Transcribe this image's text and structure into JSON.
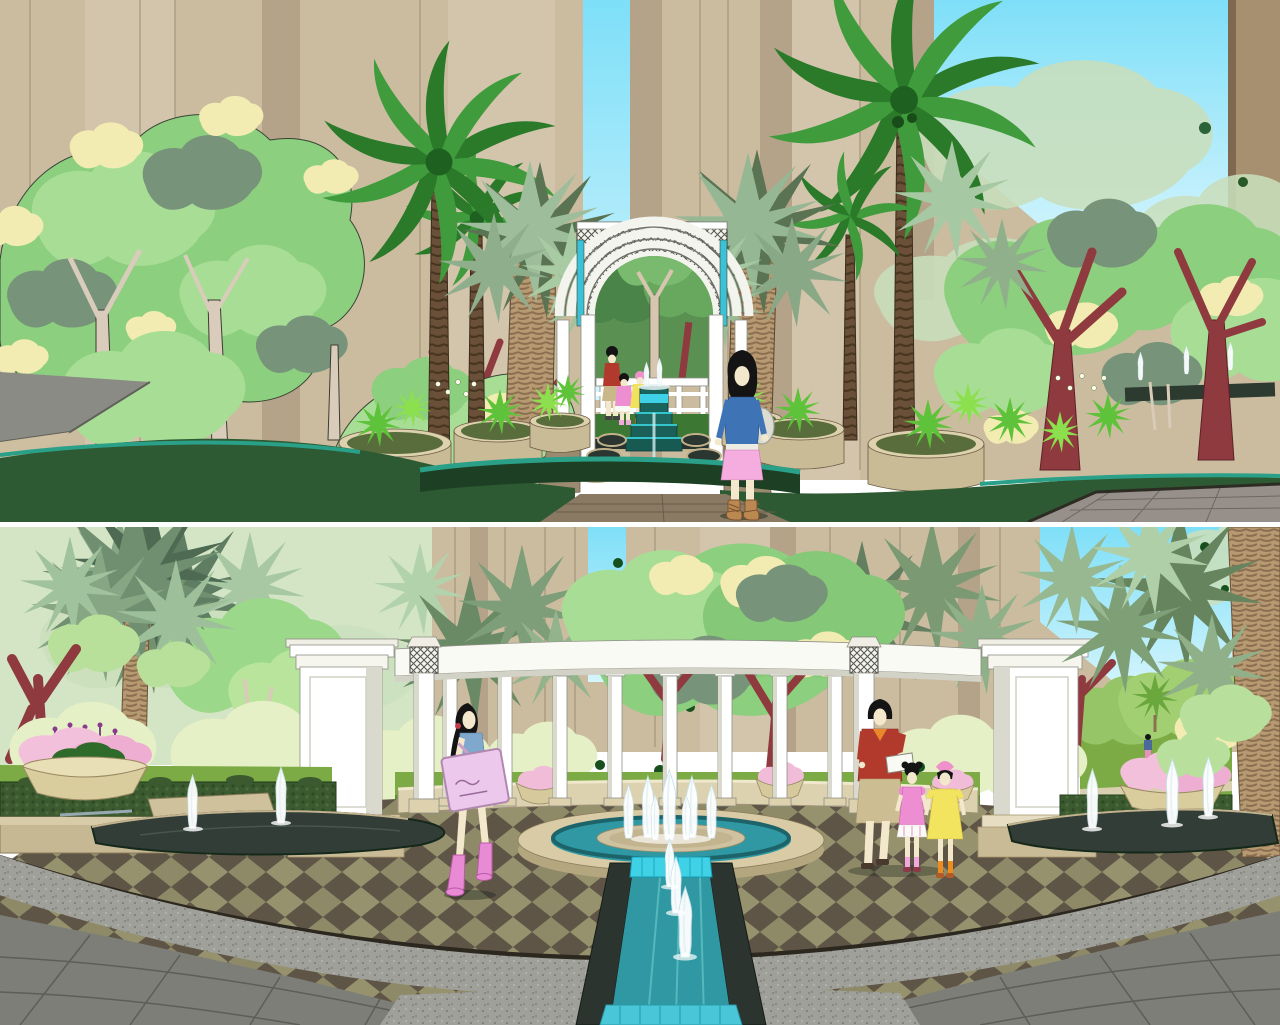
{
  "scene": {
    "type": "architectural-landscape-rendering",
    "style": "sketchup-colored-perspective, two stacked views",
    "panels": [
      {
        "id": "top",
        "name": "palm-lined walkway with white lattice archway and stepped cascade fountain",
        "elements": [
          "apartment-tower-backdrop",
          "sky-strip",
          "coconut-palms",
          "fan-palms",
          "broadleaf-trees",
          "maroon-trunk-trees",
          "white-lattice-archway",
          "teal-accent-panels",
          "distant-pergola",
          "stepped-cascade-fountain",
          "scalloped-side-pools",
          "round-planters",
          "ornamental-grasses",
          "white-flower-beds",
          "dark-lawn",
          "teal-lawn-edging",
          "gray-road",
          "paver-walkway",
          "distant-fountain-jets"
        ],
        "people": [
          {
            "id": "woman-walking",
            "hair": "black",
            "top": "blue long-sleeve",
            "skirt": "pink",
            "legs": "cream leggings",
            "boots": "tan",
            "bag": "white shoulder bag"
          },
          {
            "id": "mother-distant",
            "shirt": "red",
            "skirt": "khaki"
          },
          {
            "id": "child-distant-pink",
            "dress": "pink"
          },
          {
            "id": "child-distant-yellow",
            "dress": "yellow"
          }
        ],
        "fountain": {
          "cascade_steps": 3,
          "head_jets": 2,
          "side_pools": 6
        }
      },
      {
        "id": "bottom",
        "name": "circular white colonnade plaza with fountain ring, water channel and jet pools",
        "elements": [
          "apartment-tower-backdrop",
          "sky-strip",
          "curved-colonnade-beam",
          "end-pillars",
          "round-columns",
          "lattice-capital-pillars",
          "curved-balustrade",
          "flower-urns",
          "center-fountain-ring",
          "island-jet-cluster",
          "water-channel",
          "channel-jets",
          "left-pool-jets",
          "right-pool-jets",
          "checkerboard-paving",
          "dark-edge-band",
          "granite-band",
          "gray-corner-pavers",
          "hedges",
          "planter-boxes",
          "big-fan-palm",
          "right-palm-trunk",
          "distant-lawn-mound",
          "tiny-distant-figure"
        ],
        "people": [
          {
            "id": "girl-walking",
            "hair": "long black with red band",
            "top": "blue tank",
            "shorts": "purple",
            "boots": "pink",
            "bag": "large pink tote with scribble print"
          },
          {
            "id": "mother",
            "shirt": "red with orange collar",
            "skirt": "khaki",
            "holding": "white paper"
          },
          {
            "id": "daughter-pink",
            "dress": "pink with white hem",
            "socks": "pink"
          },
          {
            "id": "daughter-yellow",
            "dress": "yellow",
            "hat": "pink bow",
            "socks": "orange"
          }
        ],
        "colonnade": {
          "round_columns": 8,
          "lattice_pillars": 2,
          "end_pillars": 2
        },
        "fountains": {
          "center_jets": 7,
          "channel_jets": 3,
          "left_pool_jets": 2,
          "right_pool_jets": 3
        }
      }
    ]
  },
  "palette": {
    "sky_top": "#7edff8",
    "sky_bottom": "#d6f5fd",
    "building_tan": "#cbbca0",
    "building_light": "#d3c4ac",
    "building_dark": "#b4a389",
    "building_line": "#9b8c74",
    "building_tower": "#a7906f",
    "silhouette_green": "#c9dfbc",
    "backdrop_wash": "#d4e5c5",
    "tree_green": "#8ccf7e",
    "tree_light": "#a8dd96",
    "tree_highlight": "#f2ecb2",
    "tree_accent": "#77947a",
    "trunk_pale": "#d9ccba",
    "palm_dark": "#2a7a2a",
    "palm_mid": "#3f9b3c",
    "fan_sage": "#9dbd9b",
    "fan_dark": "#66855f",
    "fan_pale": "#aecfa8",
    "palm_trunk_brown": "#6a5038",
    "palm_trunk_tan": "#b89a72",
    "maroon_trunk": "#8e3a3f",
    "lawn_dark": "#2d5a32",
    "lawn_mid": "#3c7834",
    "lawn_bright": "#7cab46",
    "hedge_dark": "#3c5a30",
    "teal_stripe": "#2aa088",
    "water_teal": "#2f98a2",
    "water_cyan": "#3fd2e6",
    "cascade_dark": "#19655e",
    "pool_dark": "#333d37",
    "stone_tan": "#c9bb96",
    "stone_light": "#ded2ae",
    "stone_face": "#b4a67e",
    "balustrade": "#ddd2b0",
    "white_structure": "#ffffff",
    "white_shade": "#d9d9cd",
    "structure_outline": "#8e8e84",
    "paver_gray": "#7d7e77",
    "paver_line": "#5d5e57",
    "granite_gray": "#a0a09a",
    "checker_olive": "#8e8a68",
    "checker_brown": "#5e5546",
    "band_dark": "#2c2820",
    "path_brown": "#8a7a64",
    "road_gray": "#8b8b85",
    "skin": "#f4e8cc",
    "hair_black": "#141414",
    "woman_top_blue": "#3e74b6",
    "woman_skirt_pink": "#f5acdf",
    "woman_boots_tan": "#bb8852",
    "woman_bag_gray": "#dcdcd2",
    "mom_shirt_red": "#b23a2c",
    "mom_collar_orange": "#e8882a",
    "mom_skirt_khaki": "#cdbd92",
    "girl_dress_pink": "#ee8ed2",
    "girl_dress_yellow": "#f2e45e",
    "girl_socks_orange": "#ef8a1e",
    "teen_top_blue": "#7fa8cc",
    "teen_shorts_purple": "#8a68c8",
    "teen_boots_pink": "#e88ad4",
    "teen_bag_pink": "#ecc8ec",
    "flower_pink": "#f2c0da",
    "flower_stem_purple": "#7a4888"
  }
}
